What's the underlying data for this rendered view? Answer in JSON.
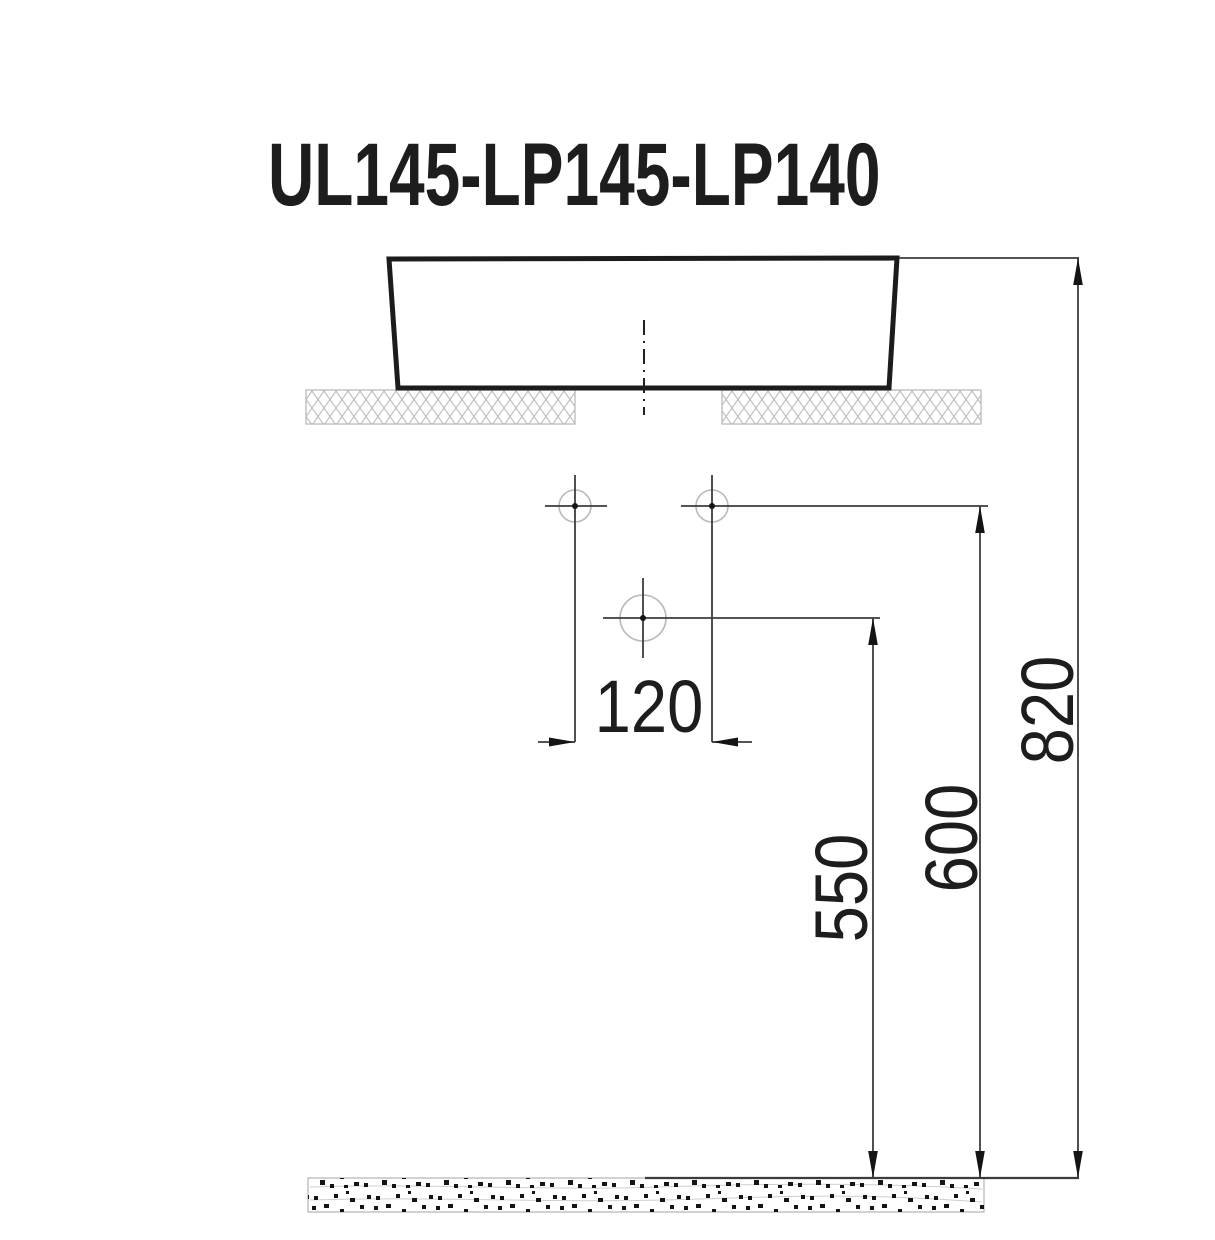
{
  "drawing": {
    "title": "UL145-LP145-LP140",
    "type_note": "technical installation drawing of a countertop washbasin, side elevation with mounting dimensions",
    "dims": {
      "hole_spacing": "120",
      "drain_outlet_height": "550",
      "faucet_holes_height": "600",
      "basin_rim_height": "820"
    },
    "colors": {
      "background": "#ffffff",
      "basin_outline": "#1c1c1c",
      "thin_line": "#3c3c3c",
      "light_line": "#b5b5b5",
      "speckle": "#141414",
      "text": "#1d1d1d"
    }
  }
}
